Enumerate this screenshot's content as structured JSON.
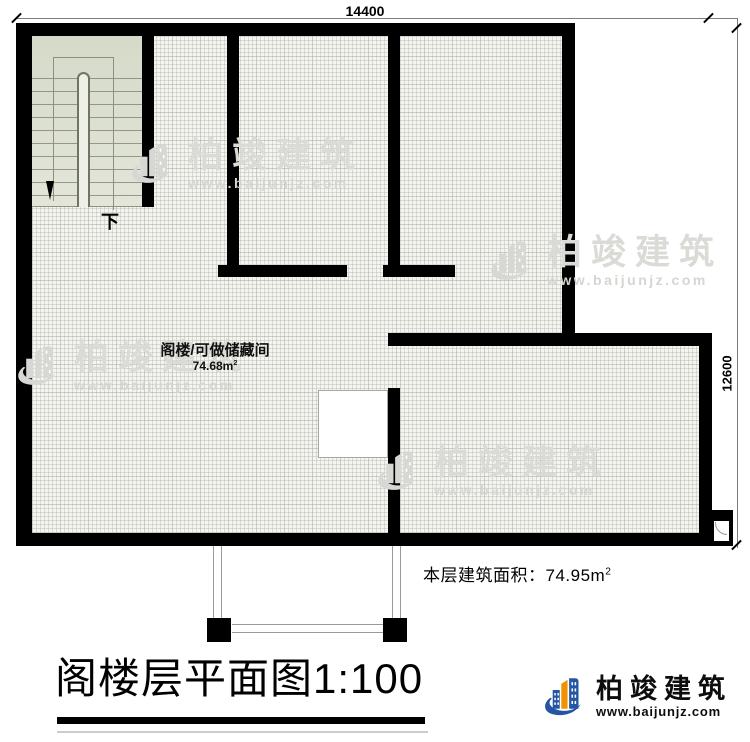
{
  "plan": {
    "dim_top": "14400",
    "dim_right": "12600",
    "stair_down_label": "下",
    "room_label": "阁楼/可做储藏间",
    "room_area": "74.68m",
    "room_area_sup": "2",
    "floor_area_label": "本层建筑面积：",
    "floor_area_value": "74.95m",
    "floor_area_sup": "2"
  },
  "title": {
    "main": "阁楼层平面图",
    "scale": "1:100"
  },
  "brand": {
    "name": "柏竣建筑",
    "url": "www.baijunjz.com"
  },
  "watermark": {
    "name": "柏竣建筑",
    "url": "www.baijunjz.com"
  },
  "colors": {
    "wall": "#000000",
    "room_fill": "#f4f4f1",
    "stair_fill": "#dde0d3",
    "brand_blue": "#2456a4",
    "brand_orange": "#f29200",
    "watermark_gray": "#d7d7d3"
  }
}
